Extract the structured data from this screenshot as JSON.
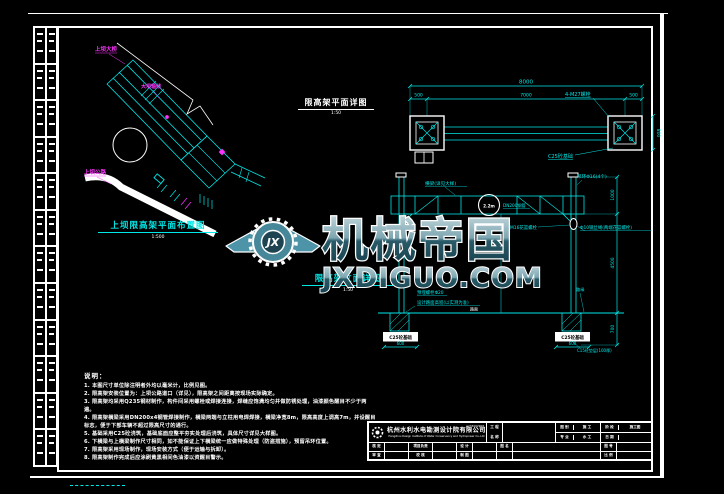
{
  "margin_strip": {
    "rows": 12
  },
  "watermark": {
    "logo_text": "JX",
    "brand_cn": "机械帝国",
    "brand_domain": "JXDIGUO.COM"
  },
  "site_plan": {
    "title": "上坝限高架平面布置图",
    "scale": "1:500",
    "labels": {
      "bridge": "上坝大桥",
      "axis": "大坝轴线",
      "road": "上坝公路"
    }
  },
  "plan_detail": {
    "title": "限高架平面详图",
    "scale": "1:50",
    "dims": {
      "overall": "8000",
      "left": "500",
      "mid": "7000",
      "right": "500",
      "side": "800"
    },
    "labels": {
      "bolts": "4-M27螺栓",
      "base": "C25砼基础"
    }
  },
  "elevation": {
    "title": "限高架立面详图",
    "scale": "1:50",
    "sign": "2.2m",
    "labels": {
      "beam": "横梁(详见大样)",
      "hook": "吊环Φ16(4个)",
      "pipe": "DN200钢管",
      "turnbuckle": "M16花篮螺栓",
      "wire": "Φ10钢丝绳(两端花篮螺栓)",
      "anchor": "预埋螺栓Φ20",
      "road_level": "设计路面高程(以实测为准)",
      "road": "路面",
      "curb": "路缘",
      "base": "C25砼基础",
      "pad": "C15砼垫层(100厚)"
    },
    "dims": {
      "top": "1000",
      "clear": "4500",
      "embed": "700",
      "footing": "600"
    }
  },
  "notes": {
    "heading": "说明：",
    "lines": [
      "1. 本图尺寸单位除注明者外均以毫米计，比例见图。",
      "2. 限高架安装位置为：上坝公路道口（详见），限高架之间距离按现场实际确定。",
      "3. 限高架均采用Q235钢材制作，构件间采用螺栓或焊接连接，焊缝应饱满均匀并做防锈处理，油漆颜色醒目不少于两遍。",
      "4. 限高架横梁采用DN200x4钢管焊接制作，横梁两端与立柱用电焊焊接，横梁净宽8m，限高高度上调高7m，并设醒目标志，便于下部车辆不超过限高尺寸的通行。",
      "5. 基础采用C25砼浇筑，基础底面应整平夯实处理后浇筑，具体尺寸详见大样图。",
      "6. 下横梁与上横梁制作尺寸相同，如不能保证上下横梁统一应做特殊处理（防盗措施），预留吊环位置。",
      "7. 限高架采用现场制作，现场安装方式（便于运输与拆卸）。",
      "8. 限高架制作完成后应涂刷黄黑相间色油漆以资醒目警示。"
    ]
  },
  "title_block": {
    "company_cn": "杭州水利水电勘测设计院有限公司",
    "company_en": "Hangzhou Design Institute of Water Conservancy and Hydropower Co.,Ltd",
    "cert_no": "A233002968",
    "top": {
      "project_l1": "工 程",
      "project_l2": "名 称",
      "project_value": "",
      "p1r1_label": "图 别",
      "p1r1_value": "施 工",
      "p1r2_label": "专 业",
      "p1r2_value": "水 工",
      "p2r1_label": "阶 段",
      "p2r1_value": "施工图",
      "p2r2_label": "日 期",
      "p2r2_value": ""
    },
    "bottom": {
      "r1c1": "核 定",
      "r1c2": "项目负责",
      "r1c3": "设 计",
      "r2c1": "审 查",
      "r2c2": "校 核",
      "r2c3": "制 图",
      "name_label": "图 名",
      "name_value": "",
      "no_label": "图 号",
      "no_value": "",
      "scale_label": "比 例",
      "scale_value": ""
    }
  }
}
